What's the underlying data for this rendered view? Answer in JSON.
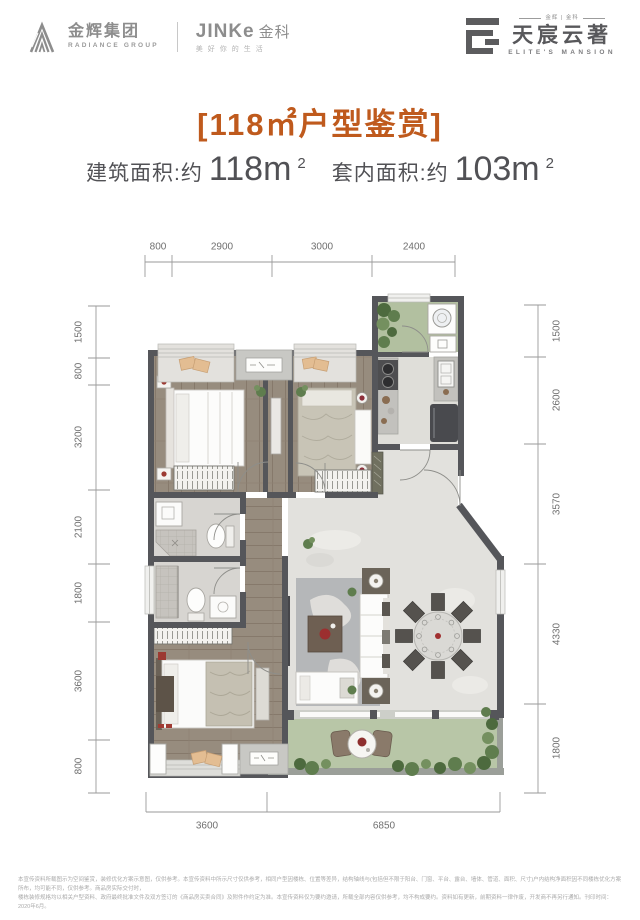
{
  "header": {
    "radiance_cn": "金辉集团",
    "radiance_en": "RADIANCE GROUP",
    "jinke_en": "JINKe",
    "jinke_cn": "金科",
    "jinke_slogan": "美好你的生活",
    "mansion_small": "金辉 | 金科",
    "mansion_cn": "天宸云著",
    "mansion_en": "ELITE'S MANSION"
  },
  "title": "[118㎡户型鉴赏]",
  "subtitle": {
    "label1": "建筑面积:约",
    "value1": "118m",
    "sup1": "2",
    "label2": "套内面积:约",
    "value2": "103m",
    "sup2": "2"
  },
  "floor_plan": {
    "dimensions_mm": {
      "top": [
        "800",
        "2900",
        "3000",
        "2400"
      ],
      "left": [
        "1500",
        "800",
        "3200",
        "2100",
        "1800",
        "3600",
        "800"
      ],
      "right": [
        "1500",
        "2600",
        "3570",
        "4330",
        "1800"
      ],
      "bottom": [
        "3600",
        "6850"
      ]
    }
  },
  "disclaimer": {
    "line1": "本宣传资料所载图示为空间鉴赏，装修优化方案示意图，仅供参考。本宣传资料中所示尺寸仅供参考，相同户型因楼栋、位置等差异，结构轴线与(包括但不限于阳台、门窗、平台、露台、墙体、管道、面积、尺寸)户内结构净面积因不同楼栋优化方案所布，均可能不同，仅供参考。商品房实际交付时，",
    "line2": "楼栋装修规格均以相关户型资料、政府最终批准文件及双方签订的《商品房买卖合同》及附件作约定为准。本宣传资料仅为要约邀请，所载全部内容仅供参考，均不构成要约。资料如有更新，前期资料一律作废，开发商不再另行通知。刊印时间：2020年6月。"
  },
  "colors": {
    "accent_orange": "#bf5a1d",
    "wall_gray": "#55565a",
    "wood_floor": "#978c7e",
    "marble_floor": "#e2e1dd",
    "balcony_green": "#b8c6a7",
    "text_gray": "#515155"
  }
}
